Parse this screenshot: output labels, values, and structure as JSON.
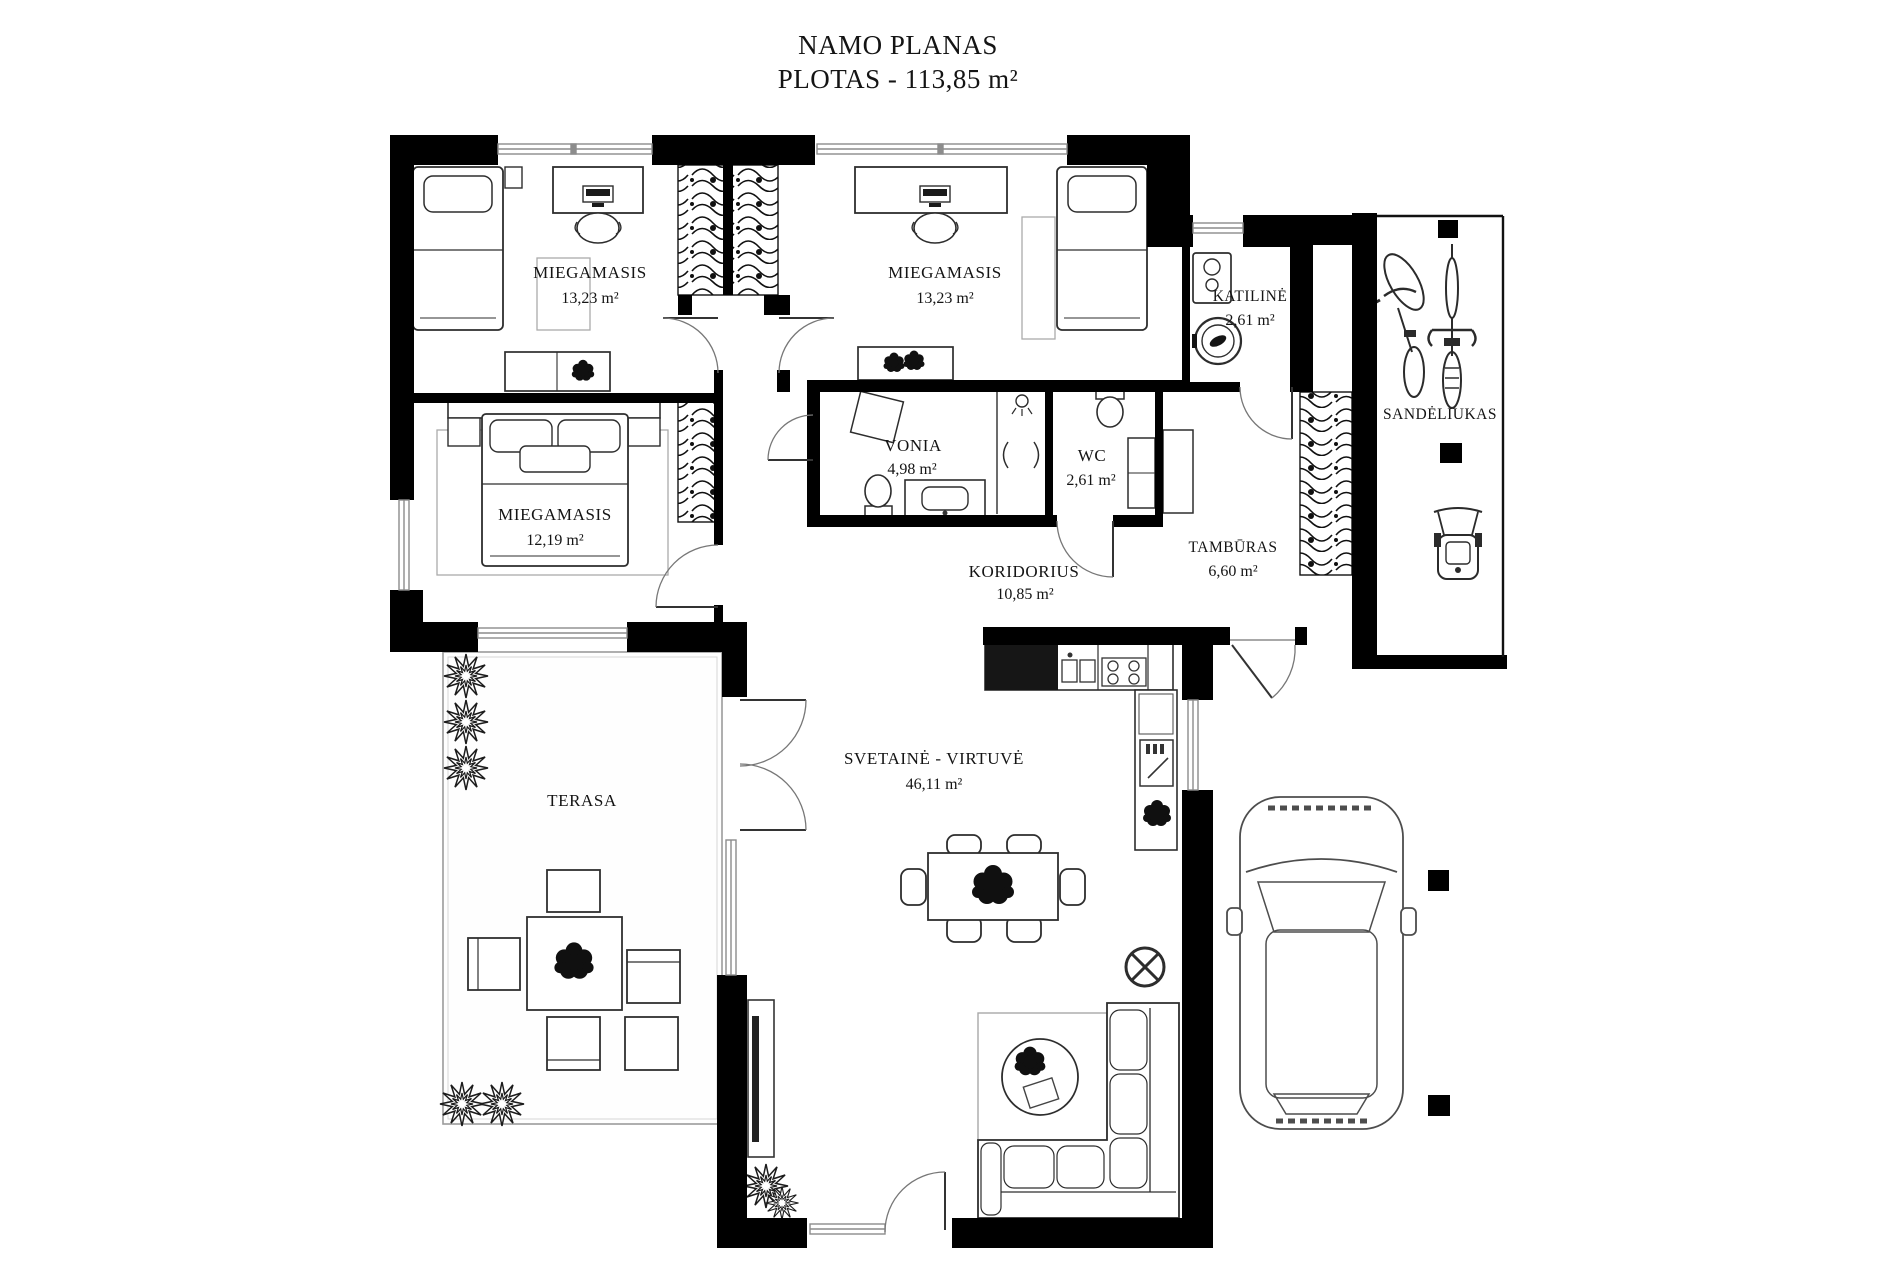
{
  "title": {
    "line1": "NAMO PLANAS",
    "line2": "PLOTAS - 113,85 m²"
  },
  "rooms": {
    "bedroom1": {
      "name": "MIEGAMASIS",
      "area": "13,23 m²"
    },
    "bedroom2": {
      "name": "MIEGAMASIS",
      "area": "13,23 m²"
    },
    "bedroom3": {
      "name": "MIEGAMASIS",
      "area": "12,19 m²"
    },
    "boiler": {
      "name": "KATILINĖ",
      "area": "2,61 m²"
    },
    "bath": {
      "name": "VONIA",
      "area": "4,98 m²"
    },
    "wc": {
      "name": "WC",
      "area": "2,61 m²"
    },
    "corridor": {
      "name": "KORIDORIUS",
      "area": "10,85 m²"
    },
    "vestibule": {
      "name": "TAMBŪRAS",
      "area": "6,60 m²"
    },
    "storage": {
      "name": "SANDĖLIUKAS"
    },
    "terrace": {
      "name": "TERASA"
    },
    "living": {
      "name": "SVETAINĖ - VIRTUVĖ",
      "area": "46,11 m²"
    }
  },
  "colors": {
    "wall": "#000000",
    "line": "#3a3a3a",
    "window": "#8c8c8c",
    "paper": "#ffffff"
  }
}
